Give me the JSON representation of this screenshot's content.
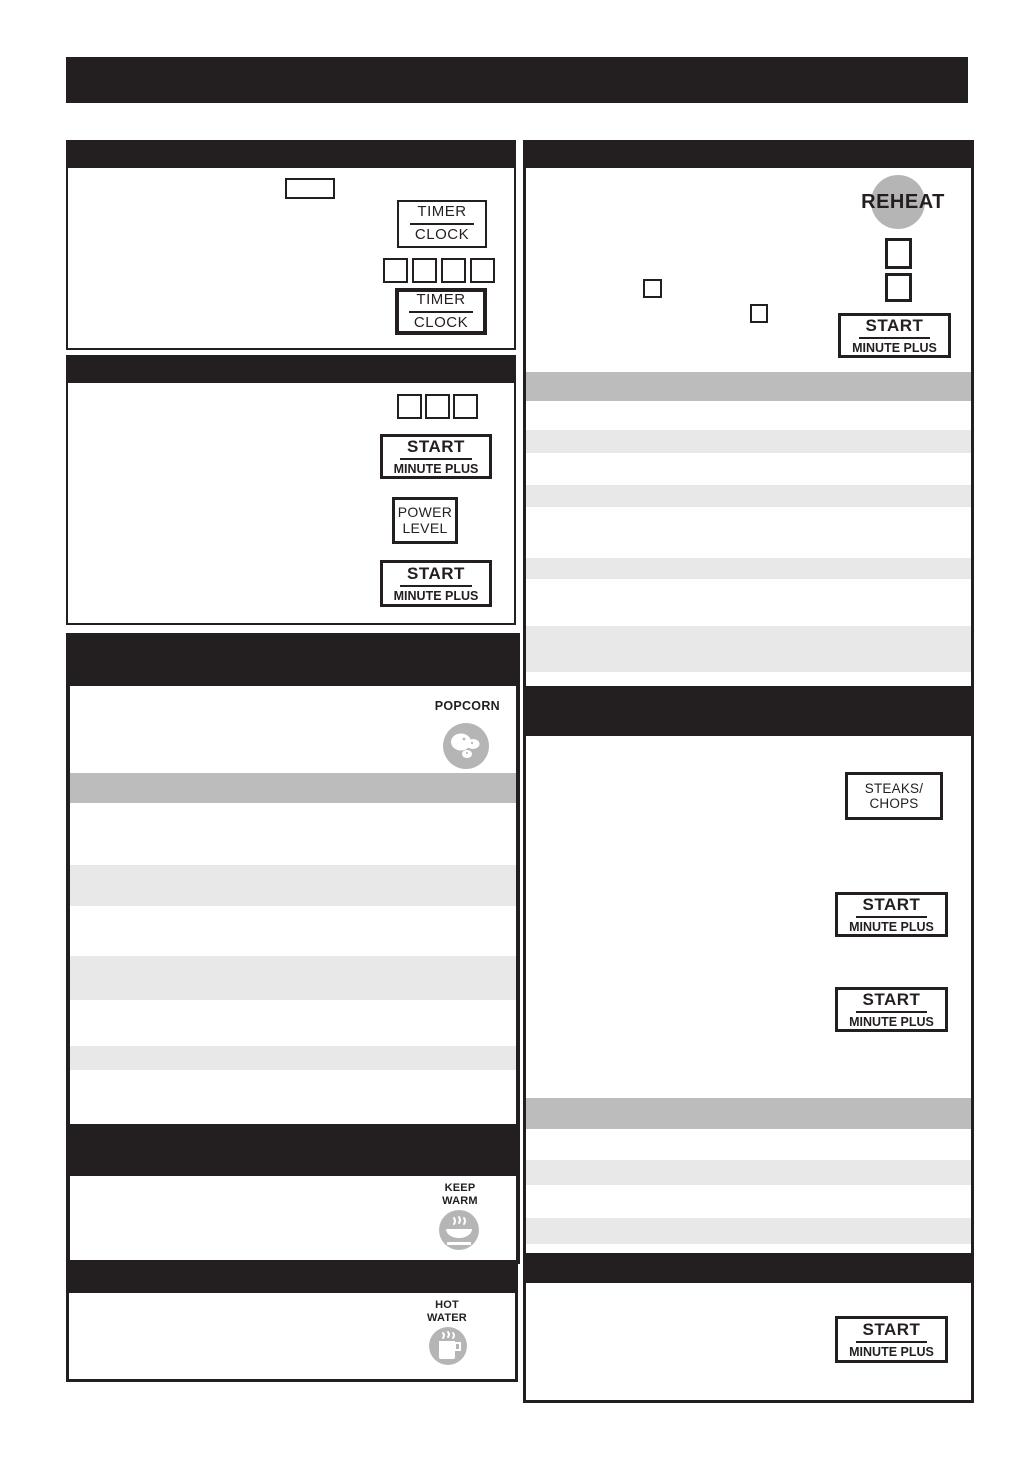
{
  "colors": {
    "ink": "#231f20",
    "stripe_dark": "#bcbcbc",
    "stripe_light": "#e8e8e8",
    "icon_gray": "#b5b5b5"
  },
  "keys": {
    "timer_clock": {
      "top": "TIMER",
      "bottom": "CLOCK"
    },
    "start_minute_plus": {
      "top": "START",
      "bottom": "MINUTE PLUS"
    },
    "power_level": {
      "top": "POWER",
      "bottom": "LEVEL"
    },
    "steaks_chops": {
      "top": "STEAKS/",
      "bottom": "CHOPS"
    }
  },
  "labels": {
    "reheat": "REHEAT",
    "popcorn": "POPCORN",
    "keep_warm": {
      "line1": "KEEP",
      "line2": "WARM"
    },
    "hot_water": {
      "line1": "HOT",
      "line2": "WATER"
    }
  },
  "icons": {
    "popcorn": "popcorn-icon",
    "keep_warm": "bowl-steam-icon",
    "hot_water": "mug-steam-icon"
  }
}
